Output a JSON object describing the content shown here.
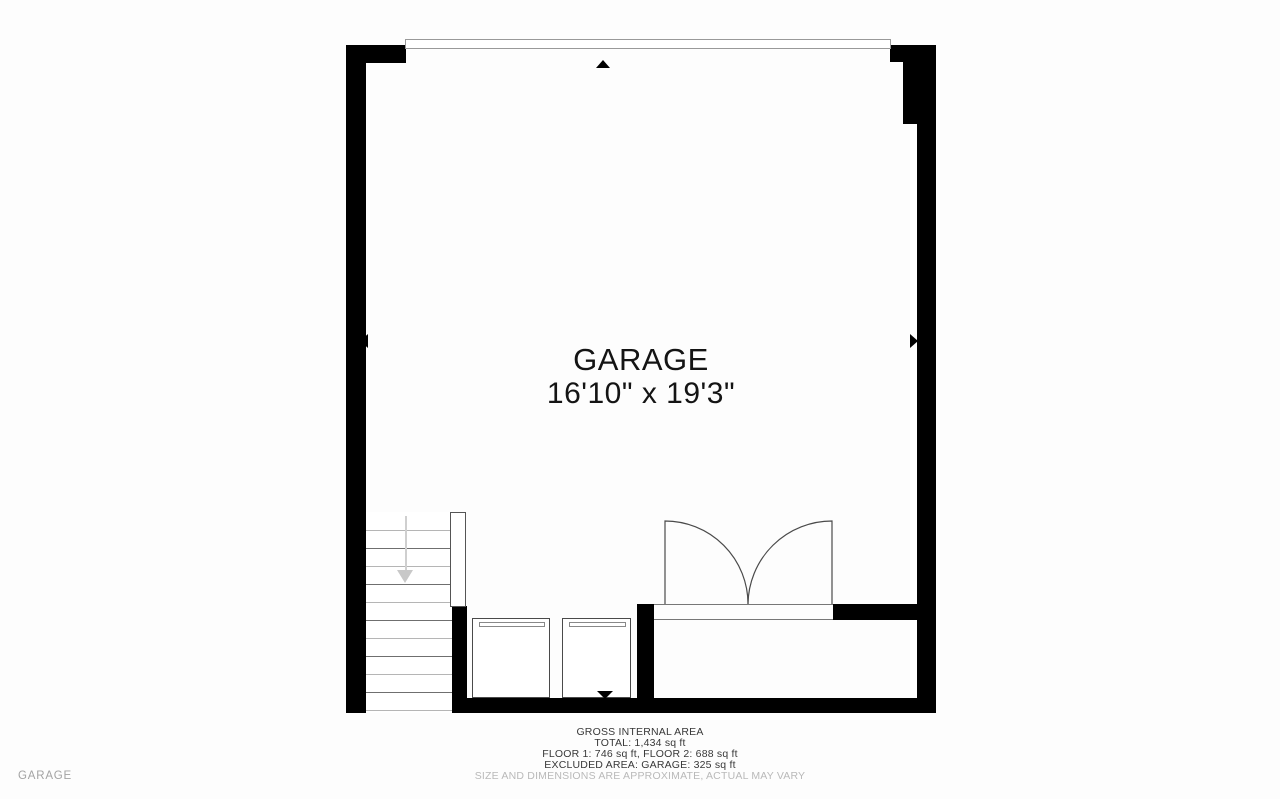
{
  "page": {
    "background": "#fdfdfd",
    "floor_label": "GARAGE"
  },
  "plan": {
    "room": {
      "name": "GARAGE",
      "dimensions": "16'10\" x 19'3\""
    },
    "colors": {
      "wall": "#000000",
      "tread_light": "#b5b5b5",
      "tread_dark": "#6f6f6f",
      "stairs_arrow": "#c8c8c8",
      "door_line": "#4a4a4a",
      "garage_door_outline": "#999999"
    },
    "icons": {
      "top_marker": "arrow-up-icon",
      "bottom_marker": "arrow-down-icon",
      "left_marker": "arrow-left-icon",
      "right_marker": "arrow-right-icon",
      "stairs_direction": "stairs-down-arrow-icon"
    }
  },
  "footer": {
    "heading": "GROSS INTERNAL AREA",
    "total": "TOTAL: 1,434 sq ft",
    "floors": "FLOOR 1: 746 sq ft, FLOOR 2: 688 sq ft",
    "excluded": "EXCLUDED AREA: GARAGE: 325 sq ft",
    "disclaimer": "SIZE AND DIMENSIONS ARE APPROXIMATE, ACTUAL MAY VARY"
  }
}
